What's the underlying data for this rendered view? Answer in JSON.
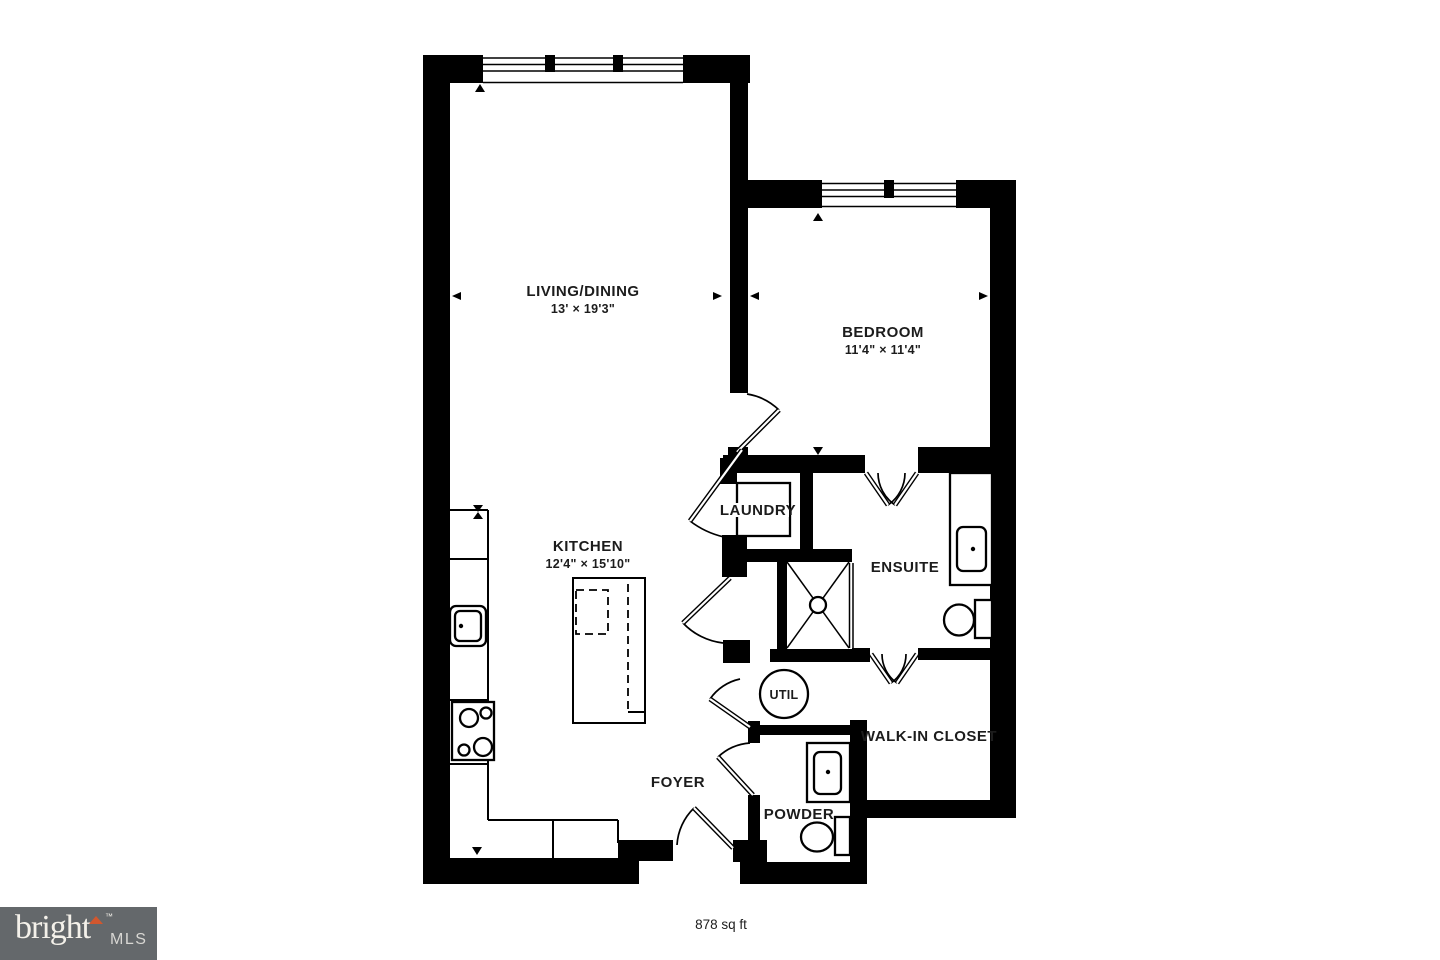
{
  "plan": {
    "rooms": {
      "living": {
        "name": "LIVING/DINING",
        "dims": "13' × 19'3\""
      },
      "bedroom": {
        "name": "BEDROOM",
        "dims": "11'4\" × 11'4\""
      },
      "kitchen": {
        "name": "KITCHEN",
        "dims": "12'4\" × 15'10\""
      },
      "laundry": {
        "name": "LAUNDRY"
      },
      "ensuite": {
        "name": "ENSUITE"
      },
      "util": {
        "name": "UTIL"
      },
      "walk_in_closet": {
        "name": "WALK-IN CLOSET"
      },
      "foyer": {
        "name": "FOYER"
      },
      "powder": {
        "name": "POWDER"
      }
    },
    "total_area": "878 sq ft"
  },
  "logo": {
    "brand": "bright",
    "trademark": "™",
    "suffix": "MLS"
  },
  "colors": {
    "wall": "#000000",
    "background": "#ffffff",
    "label_text": "#1c1c1c",
    "logo_background": "#64686b",
    "logo_brand_text": "#f4f1ea",
    "logo_suffix_text": "#d8d7d3",
    "logo_accent": "#d2572e"
  }
}
